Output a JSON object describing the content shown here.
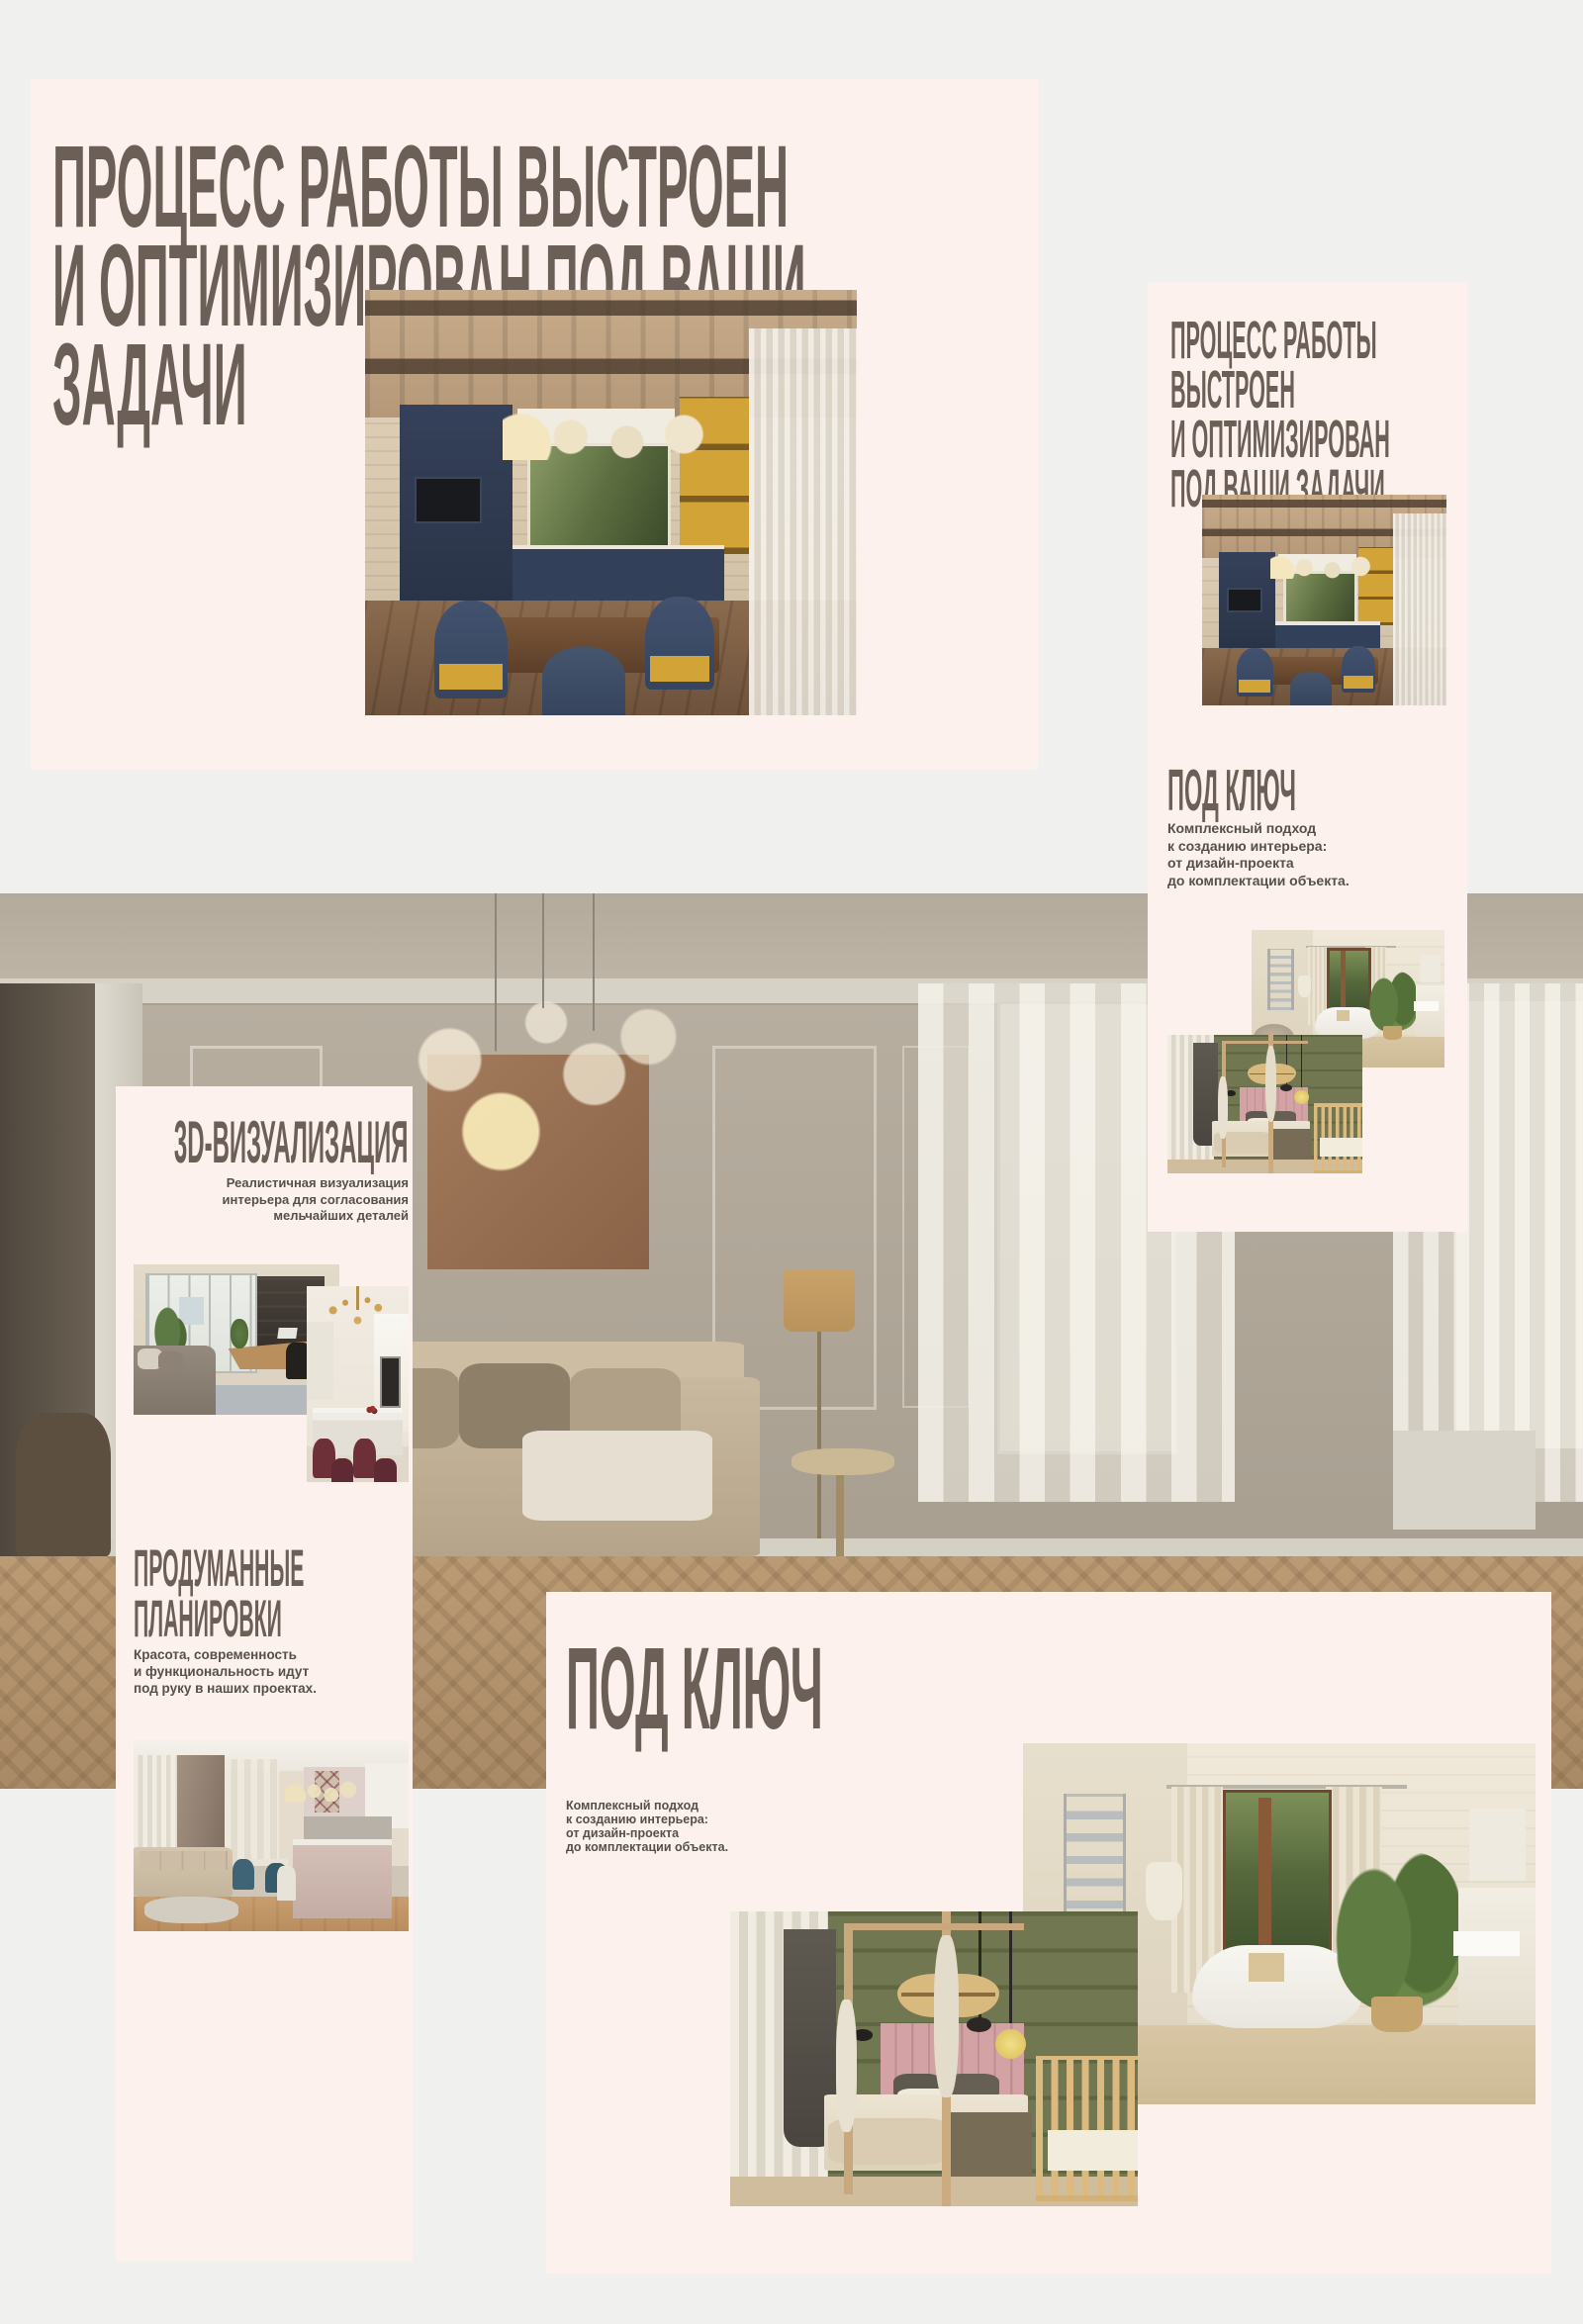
{
  "page": {
    "background": "#f0f0ee"
  },
  "theme": {
    "card_background": "#fcf1ec",
    "heading_color": "#6c5f57",
    "body_text_color": "#55504a"
  },
  "cards": {
    "process_large": {
      "heading_lines": [
        "ПРОЦЕСС РАБОТЫ ВЫСТРОЕН",
        "И ОПТИМИЗИРОВАН ПОД ВАШИ",
        "ЗАДАЧИ"
      ]
    },
    "process_small": {
      "heading_lines": [
        "ПРОЦЕСС РАБОТЫ",
        "ВЫСТРОЕН",
        "И ОПТИМИЗИРОВАН",
        "ПОД ВАШИ ЗАДАЧИ"
      ],
      "subheading": "ПОД КЛЮЧ",
      "body_lines": [
        "Комплексный подход",
        "к созданию интерьера:",
        "от дизайн-проекта",
        "до комплектации объекта."
      ]
    },
    "visualization": {
      "heading": "3D-ВИЗУАЛИЗАЦИЯ",
      "body_lines": [
        "Реалистичная визуализация",
        "интерьера для согласования",
        "мельчайших деталей"
      ],
      "heading2_lines": [
        "ПРОДУМАННЫЕ",
        "ПЛАНИРОВКИ"
      ],
      "body2_lines": [
        "Красота, современность",
        "и функциональность идут",
        "под руку в наших проектах."
      ]
    },
    "turnkey": {
      "heading": "ПОД КЛЮЧ",
      "body_lines": [
        "Комплексный подход",
        "к созданию интерьера:",
        "от дизайн-проекта",
        "до комплектации объекта."
      ]
    }
  }
}
